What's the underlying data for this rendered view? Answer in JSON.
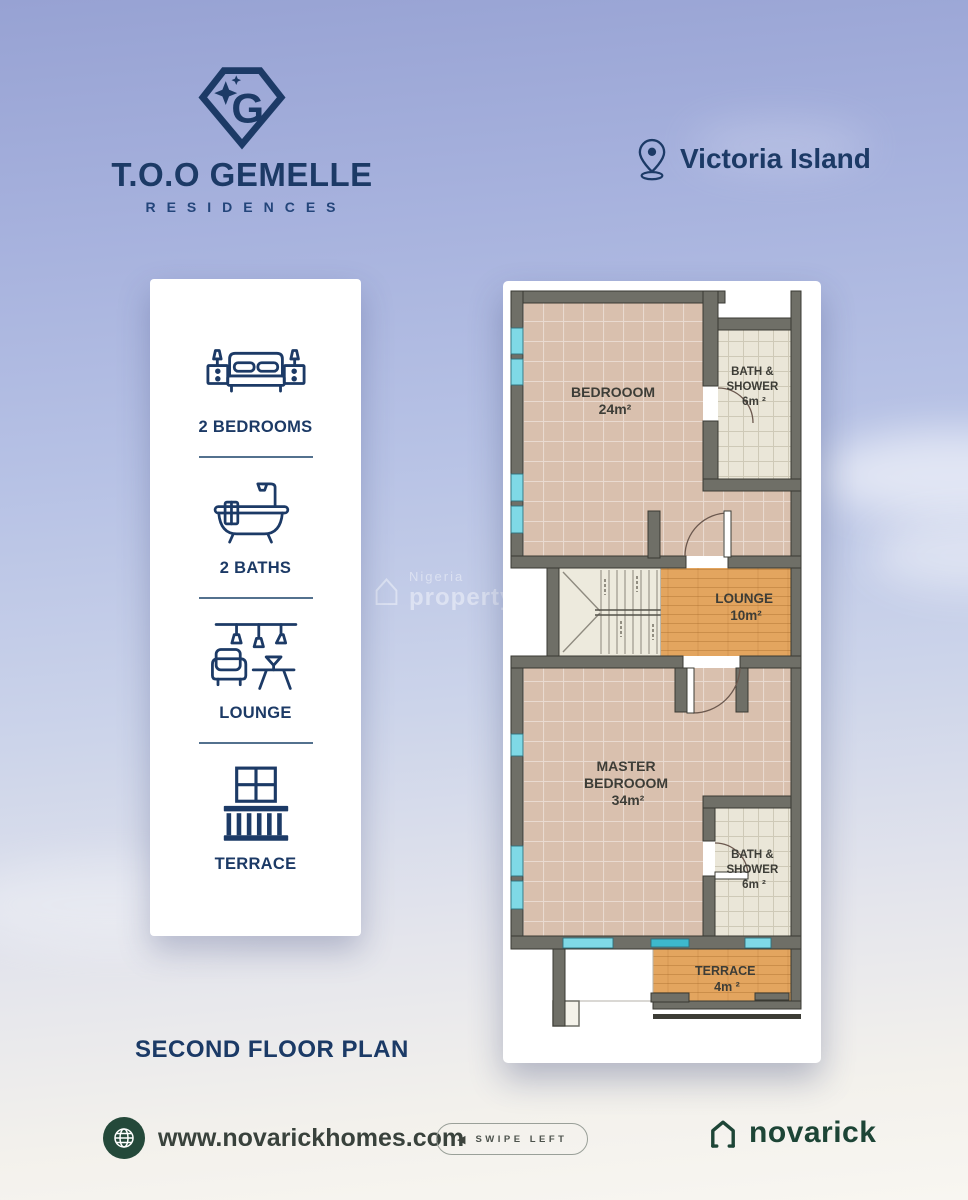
{
  "header": {
    "brand_name": "T.O.O GEMELLE",
    "brand_subtitle": "RESIDENCES",
    "location": "Victoria Island"
  },
  "amenities": {
    "items": [
      {
        "icon": "bed-icon",
        "label": "2 BEDROOMS"
      },
      {
        "icon": "bathtub-icon",
        "label": "2 BATHS"
      },
      {
        "icon": "lounge-icon",
        "label": "LOUNGE"
      },
      {
        "icon": "terrace-icon",
        "label": "TERRACE"
      }
    ]
  },
  "floor_plan": {
    "title": "SECOND FLOOR PLAN",
    "rooms": [
      {
        "name": "bedroom",
        "lines": [
          "BEDROOOM",
          "24m²"
        ]
      },
      {
        "name": "bath-shower-top",
        "lines": [
          "BATH &",
          "SHOWER",
          "6m ²"
        ]
      },
      {
        "name": "lounge",
        "lines": [
          "LOUNGE",
          "10m²"
        ]
      },
      {
        "name": "master-bedroom",
        "lines": [
          "MASTER",
          "BEDROOOM",
          "34m²"
        ]
      },
      {
        "name": "bath-shower-bottom",
        "lines": [
          "BATH &",
          "SHOWER",
          "6m ²"
        ]
      },
      {
        "name": "terrace",
        "lines": [
          "TERRACE",
          "4m ²"
        ]
      }
    ]
  },
  "watermark": {
    "icon_glyph": "⌂",
    "line1": "Nigeria",
    "line2": "propertycentre"
  },
  "footer": {
    "website": "www.novarickhomes.com",
    "swipe_arrow": "◀",
    "swipe_label": "SWIPE LEFT",
    "brand": "novarick"
  },
  "colors": {
    "navy": "#1c3a66",
    "brand_green": "#1d4536",
    "floor_tan": "#d9c0ae",
    "floor_wood": "#e3a55f",
    "floor_tile": "#eae6d8",
    "wall_gray": "#6f6f67",
    "window_cyan": "#7fd9e6",
    "sky_top": "#97a2d3",
    "sky_bottom": "#f8f6f1"
  }
}
